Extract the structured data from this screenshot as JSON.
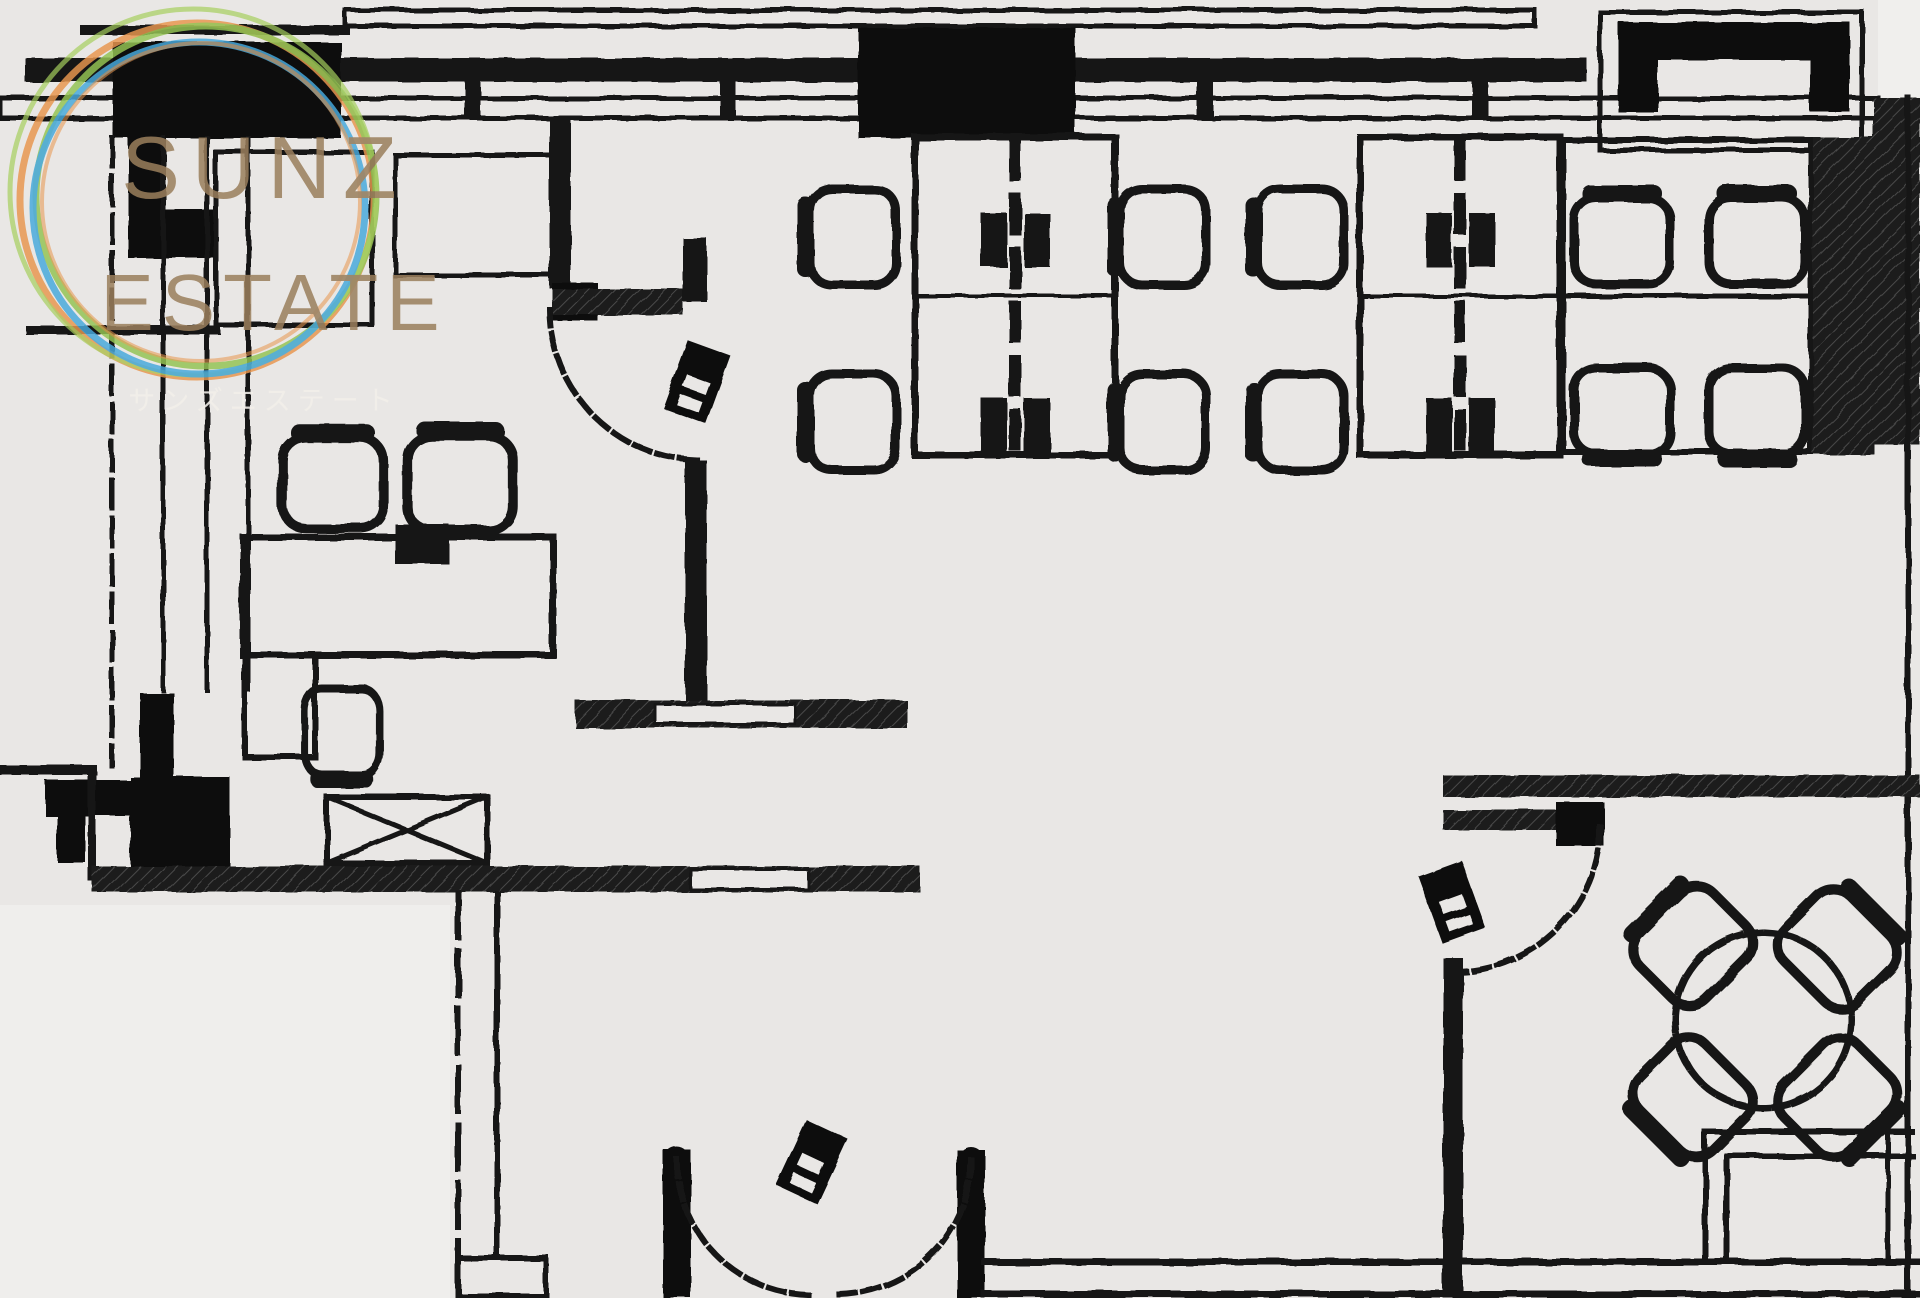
{
  "logo": {
    "line1": "SUNZ",
    "line2": "ESTATE",
    "subtitle": "サンズエステート",
    "ring_colors": {
      "orange": "#e8964f",
      "green": "#93c353",
      "blue": "#47a8dc"
    },
    "text_color": "#9b7f5d",
    "subtitle_color": "#f2efe9"
  },
  "palette": {
    "background": "#e9e7e5",
    "outside_area": "#f0efed",
    "line_color": "#171717"
  },
  "floorplan": {
    "type": "office-floor-plan",
    "visible_symbols": {
      "desk_islands": 5,
      "office_chairs": 13,
      "meeting_round_table": 1,
      "meeting_chairs": 4,
      "crossed_box_equipment": 1,
      "card_reader_marks": 3,
      "single_swing_doors": 2,
      "double_swing_door": 1,
      "structural_pillars": 4
    }
  }
}
